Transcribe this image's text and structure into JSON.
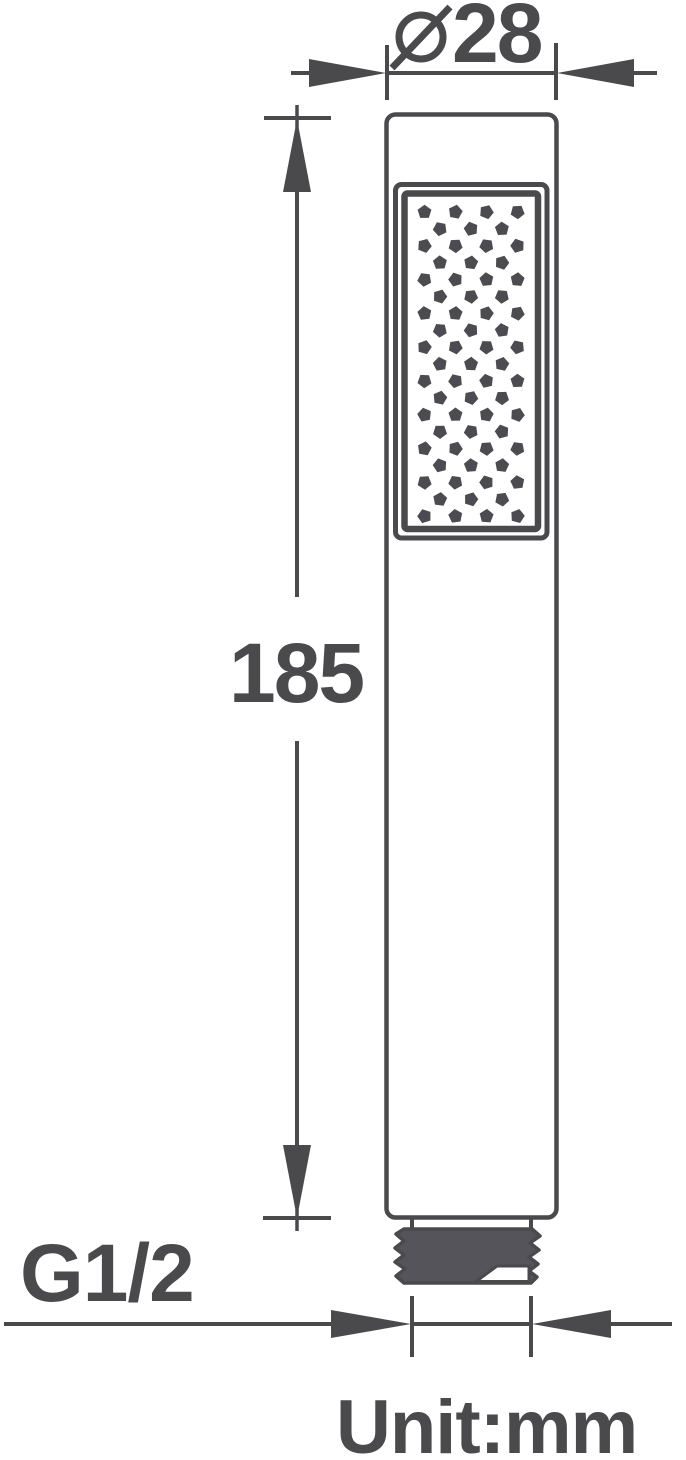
{
  "drawing": {
    "diameter_dimension": {
      "symbol": "Ø",
      "value": "28"
    },
    "length_dimension": {
      "value": "185"
    },
    "thread_label": "G1/2",
    "unit_label": "Unit:mm"
  },
  "colors": {
    "line": "#4a4a4d",
    "text": "#4a4a4d",
    "thread_fill": "#55545a",
    "nozzle_fill": "#4c4b4f",
    "background": "#ffffff"
  },
  "nozzle_pattern": {
    "dot_shape": "pentagon",
    "rows": 19,
    "start_y": 212,
    "row_spacing": 16.9,
    "x_positions_even_rows": [
      424.5,
      455.5,
      486.5,
      517.5
    ],
    "x_positions_odd_rows": [
      440,
      471,
      502
    ],
    "dot_radius": 7.3
  }
}
